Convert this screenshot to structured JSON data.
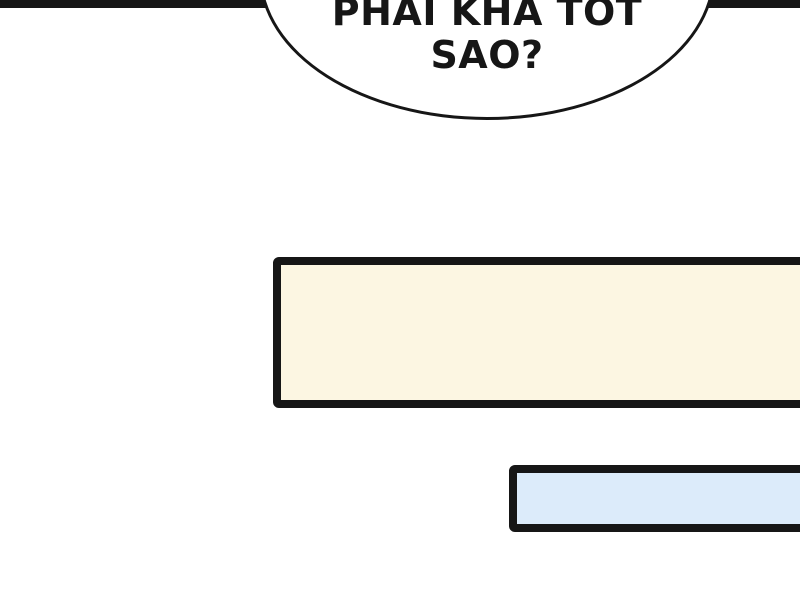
{
  "comic": {
    "speech_bubble": {
      "line1": "PHAI KHA TOT",
      "line2": "SAO?"
    },
    "panels": {
      "cream_panel": "",
      "blue_panel": ""
    },
    "colors": {
      "ink": "#161616",
      "background": "#ffffff",
      "bubble_fill": "#ffffff",
      "panel_cream_fill": "#fcf6e2",
      "panel_blue_fill": "#dcebfa"
    }
  }
}
